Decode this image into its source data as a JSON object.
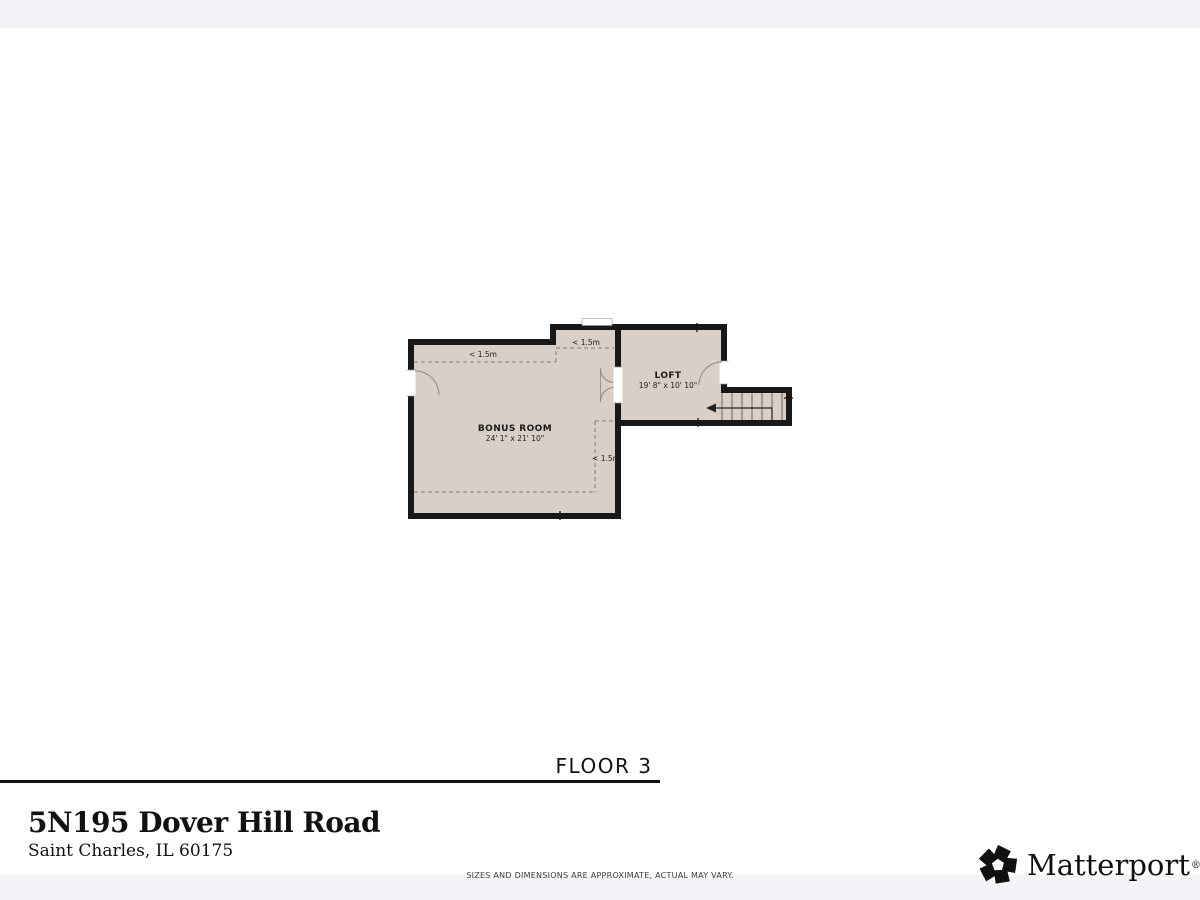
{
  "floor_label": "FLOOR 3",
  "address": {
    "line1": "5N195 Dover Hill Road",
    "line2": "Saint Charles, IL 60175"
  },
  "disclaimer": "SIZES AND DIMENSIONS ARE APPROXIMATE, ACTUAL MAY VARY.",
  "branding": {
    "name": "Matterport",
    "registered": "®"
  },
  "floor_plan": {
    "rooms": [
      {
        "name": "BONUS ROOM",
        "dimensions": "24' 1\" x 21' 10\""
      },
      {
        "name": "LOFT",
        "dimensions": "19' 8\" x 10' 10\""
      }
    ],
    "ceiling_height_labels": [
      "< 1.5m",
      "< 1.5m",
      "< 1.5m"
    ],
    "colors": {
      "floor": "#d9cfc6",
      "wall": "#181818",
      "dashed_line": "#7f7f7f",
      "page_band": "#f5f3f7"
    }
  }
}
